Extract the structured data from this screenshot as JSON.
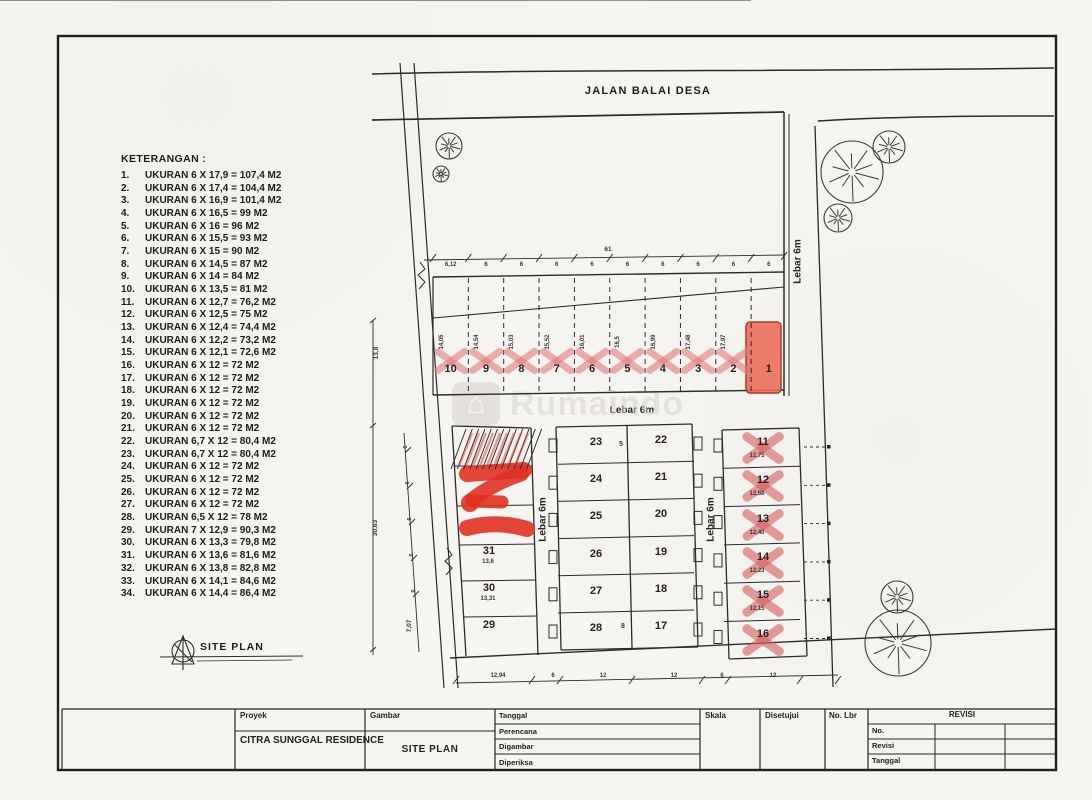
{
  "labels": {
    "road": "JALAN BALAI DESA",
    "lebar": "Lebar 6m",
    "site_plan": "SITE PLAN",
    "total_width": "61",
    "stray_marks": [
      "5",
      "8"
    ]
  },
  "watermark": {
    "text": "Rumaindo"
  },
  "legend": {
    "title": "KETERANGAN :",
    "items": [
      {
        "no": "1.",
        "text": "UKURAN 6 X 17,9 = 107,4 M2"
      },
      {
        "no": "2.",
        "text": "UKURAN 6 X 17,4 = 104,4 M2"
      },
      {
        "no": "3.",
        "text": "UKURAN 6 X 16,9 = 101,4 M2"
      },
      {
        "no": "4.",
        "text": "UKURAN 6 X 16,5 = 99 M2"
      },
      {
        "no": "5.",
        "text": "UKURAN 6 X 16 = 96 M2"
      },
      {
        "no": "6.",
        "text": "UKURAN 6 X 15,5 = 93 M2"
      },
      {
        "no": "7.",
        "text": "UKURAN 6 X 15 = 90 M2"
      },
      {
        "no": "8.",
        "text": "UKURAN 6 X 14,5 = 87 M2"
      },
      {
        "no": "9.",
        "text": "UKURAN 6 X 14 = 84 M2"
      },
      {
        "no": "10.",
        "text": "UKURAN 6 X 13,5 = 81 M2"
      },
      {
        "no": "11.",
        "text": "UKURAN 6 X 12,7 = 76,2 M2"
      },
      {
        "no": "12.",
        "text": "UKURAN 6 X 12,5 = 75 M2"
      },
      {
        "no": "13.",
        "text": "UKURAN 6 X 12,4 = 74,4 M2"
      },
      {
        "no": "14.",
        "text": "UKURAN 6 X 12,2 = 73,2 M2"
      },
      {
        "no": "15.",
        "text": "UKURAN 6 X 12,1 = 72,6 M2"
      },
      {
        "no": "16.",
        "text": "UKURAN 6 X 12 = 72 M2"
      },
      {
        "no": "17.",
        "text": "UKURAN 6 X 12 = 72 M2"
      },
      {
        "no": "18.",
        "text": "UKURAN 6 X 12 = 72 M2"
      },
      {
        "no": "19.",
        "text": "UKURAN 6 X 12 = 72 M2"
      },
      {
        "no": "20.",
        "text": "UKURAN 6 X 12 = 72 M2"
      },
      {
        "no": "21.",
        "text": "UKURAN 6 X 12 = 72 M2"
      },
      {
        "no": "22.",
        "text": "UKURAN 6,7 X 12 = 80,4 M2"
      },
      {
        "no": "23.",
        "text": "UKURAN 6,7 X 12 = 80,4 M2"
      },
      {
        "no": "24.",
        "text": "UKURAN 6 X 12 = 72 M2"
      },
      {
        "no": "25.",
        "text": "UKURAN 6 X 12 = 72 M2"
      },
      {
        "no": "26.",
        "text": "UKURAN 6 X 12 = 72 M2"
      },
      {
        "no": "27.",
        "text": "UKURAN 6 X 12 = 72 M2"
      },
      {
        "no": "28.",
        "text": "UKURAN 6,5 X 12 = 78 M2"
      },
      {
        "no": "29.",
        "text": "UKURAN 7 X 12,9 = 90,3 M2"
      },
      {
        "no": "30.",
        "text": "UKURAN 6 X 13,3 = 79,8 M2"
      },
      {
        "no": "31.",
        "text": "UKURAN 6 X 13,6 = 81,6 M2"
      },
      {
        "no": "32.",
        "text": "UKURAN 6 X 13,8 = 82,8 M2"
      },
      {
        "no": "33.",
        "text": "UKURAN 6 X 14,1 = 84,6 M2"
      },
      {
        "no": "34.",
        "text": "UKURAN 6 X 14,4 = 86,4 M2"
      }
    ]
  },
  "top_row": {
    "plots": [
      {
        "no": "10",
        "dim": "14,05",
        "sold": true
      },
      {
        "no": "9",
        "dim": "14,54",
        "sold": true
      },
      {
        "no": "8",
        "dim": "15,03",
        "sold": true
      },
      {
        "no": "7",
        "dim": "15,52",
        "sold": true
      },
      {
        "no": "6",
        "dim": "16,01",
        "sold": true
      },
      {
        "no": "5",
        "dim": "16,5",
        "sold": true
      },
      {
        "no": "4",
        "dim": "16,99",
        "sold": true
      },
      {
        "no": "3",
        "dim": "17,48",
        "sold": true
      },
      {
        "no": "2",
        "dim": "17,97",
        "sold": true
      },
      {
        "no": "1",
        "dim": "",
        "filled": true
      }
    ],
    "seg_dims": [
      "6,12",
      "6",
      "6",
      "6",
      "6",
      "6",
      "6",
      "6",
      "6",
      "6"
    ]
  },
  "center_block": {
    "left_col": [
      "23",
      "24",
      "25",
      "26",
      "27",
      "28"
    ],
    "right_col": [
      "22",
      "21",
      "20",
      "19",
      "18",
      "17"
    ]
  },
  "right_block": {
    "plots": [
      {
        "no": "11",
        "dim": "12,75"
      },
      {
        "no": "12",
        "dim": "12,58"
      },
      {
        "no": "13",
        "dim": "12,40"
      },
      {
        "no": "14",
        "dim": "12,23"
      },
      {
        "no": "15",
        "dim": "12,15"
      },
      {
        "no": "16",
        "dim": ""
      }
    ]
  },
  "left_block": {
    "plots": [
      {
        "no": "31",
        "dim": "13,6"
      },
      {
        "no": "30",
        "dim": "13,31"
      },
      {
        "no": "29",
        "dim": ""
      }
    ]
  },
  "left_dims": [
    "13,8",
    "30,63",
    "7,07"
  ],
  "left_inner_dims": [
    "6",
    "6",
    "6",
    "6",
    "6"
  ],
  "bottom_dims": [
    "12,94",
    "6",
    "12",
    "12",
    "6",
    "12"
  ],
  "title_block": {
    "proyek_label": "Proyek",
    "proyek_value": "CITRA SUNGGAL RESIDENCE",
    "gambar_label": "Gambar",
    "gambar_value": "SITE PLAN",
    "rows": [
      "Tanggal",
      "Perencana",
      "Digambar",
      "Diperiksa"
    ],
    "skala": "Skala",
    "disetujui": "Disetujui",
    "no_lbr": "No. Lbr",
    "revisi_header": "REVISI",
    "revisi_rows": [
      "No.",
      "Revisi",
      "Tanggal"
    ]
  }
}
